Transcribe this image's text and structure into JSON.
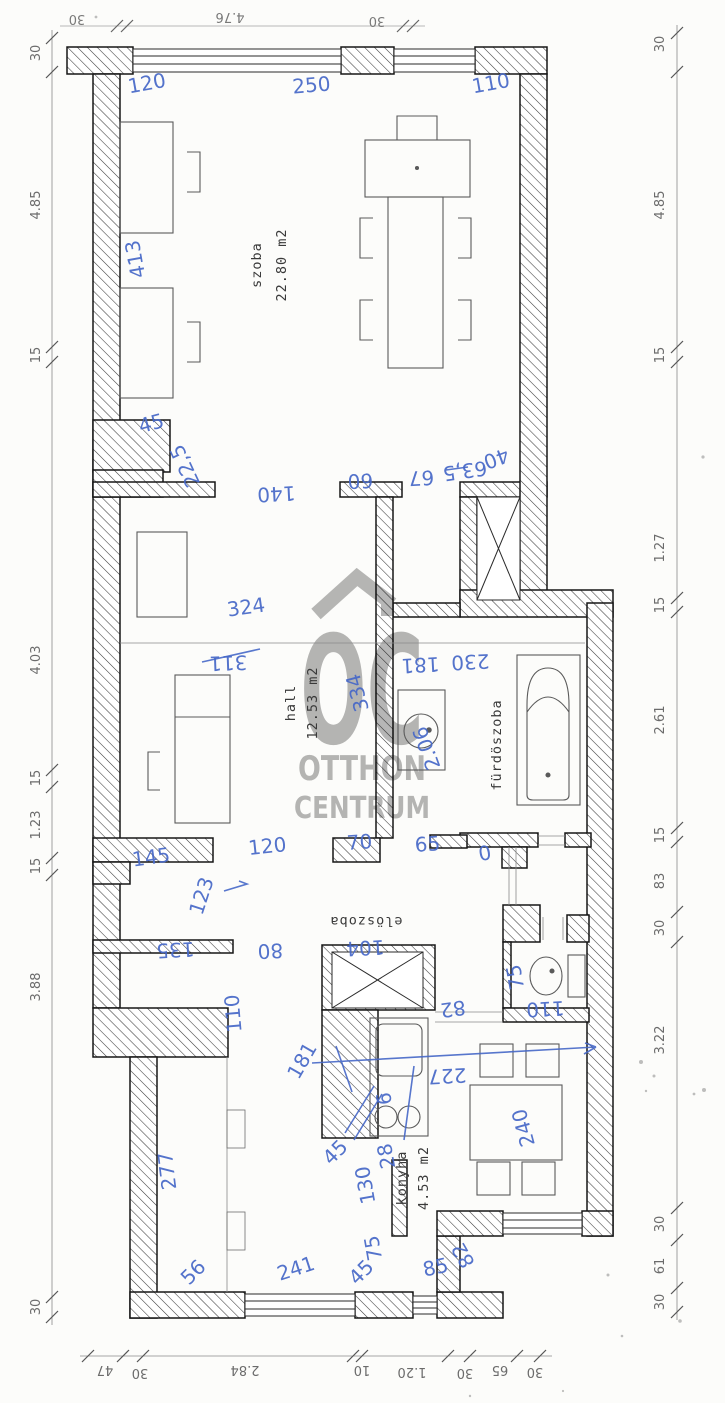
{
  "watermark": {
    "logo": "OC",
    "line1": "OTTHON",
    "line2": "CENTRUM"
  },
  "rooms": [
    {
      "name": "szoba",
      "area": "22.80 m2"
    },
    {
      "name": "hall",
      "area": "12.53 m2"
    },
    {
      "name": "fürdöszoba",
      "area": ""
    },
    {
      "name": "elöszoba",
      "area": ""
    },
    {
      "name": "konyha",
      "area": "4.53 m2"
    }
  ],
  "chains": {
    "top": [
      "30",
      "4.76",
      "30"
    ],
    "bottom": [
      "47",
      "30",
      "2.84",
      "10",
      "1.20",
      "30",
      "65",
      "30"
    ],
    "left": [
      "30",
      "4.85",
      "15",
      "4.03",
      "15",
      "1.23",
      "15",
      "3.88",
      "30"
    ],
    "right": [
      "30",
      "4.85",
      "15",
      "1.27",
      "15",
      "2.61",
      "15",
      "83",
      "30",
      "3.22",
      "30",
      "61",
      "30"
    ]
  },
  "annotations": [
    {
      "text": "120"
    },
    {
      "text": "250"
    },
    {
      "text": "110"
    },
    {
      "text": "413"
    },
    {
      "text": "45"
    },
    {
      "text": "22,5"
    },
    {
      "text": "140"
    },
    {
      "text": "60"
    },
    {
      "text": "67"
    },
    {
      "text": "63,5"
    },
    {
      "text": "40"
    },
    {
      "text": "324"
    },
    {
      "text": "311"
    },
    {
      "text": "334"
    },
    {
      "text": "181"
    },
    {
      "text": "230"
    },
    {
      "text": "2.06"
    },
    {
      "text": "145"
    },
    {
      "text": "120"
    },
    {
      "text": "70"
    },
    {
      "text": "65"
    },
    {
      "text": "0"
    },
    {
      "text": "123"
    },
    {
      "text": "135"
    },
    {
      "text": "80"
    },
    {
      "text": "104"
    },
    {
      "text": "82"
    },
    {
      "text": "75"
    },
    {
      "text": "110"
    },
    {
      "text": "110"
    },
    {
      "text": "181"
    },
    {
      "text": "227"
    },
    {
      "text": "240"
    },
    {
      "text": "277"
    },
    {
      "text": "45"
    },
    {
      "text": "130"
    },
    {
      "text": "28"
    },
    {
      "text": "6"
    },
    {
      "text": "75"
    },
    {
      "text": "45"
    },
    {
      "text": "85"
    },
    {
      "text": "82"
    },
    {
      "text": "56"
    },
    {
      "text": "241"
    }
  ]
}
